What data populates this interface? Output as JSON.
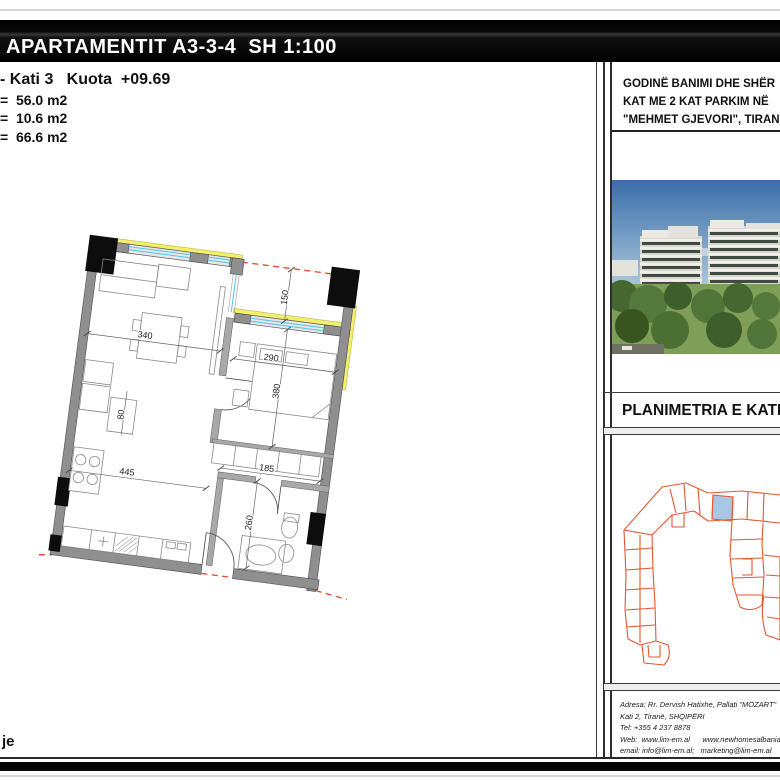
{
  "header": {
    "title": "APARTAMENTIT A3-3-4  SH 1:100"
  },
  "plan_info": {
    "floor_line": "- Kati 3   Kuota  +09.69",
    "area1": "=  56.0 m2",
    "area2": "=  10.6 m2",
    "area3": "=  66.6 m2"
  },
  "floor_plan": {
    "dims": {
      "d340": "340",
      "d150": "150",
      "d290": "290",
      "d380": "380",
      "d80": "80",
      "d445": "445",
      "d185": "185",
      "d260": "260"
    },
    "colors": {
      "wall": "#8f8f8f",
      "column": "#0d0d0d",
      "window_glass": "#4fc3e8",
      "window_sill": "#f2ef6e",
      "boundary_dash": "#e8472e"
    }
  },
  "right_panel": {
    "project_title": {
      "line1": "GODINË BANIMI DHE SHËR",
      "line2": "KAT ME 2 KAT PARKIM NË",
      "line3": "\"MEHMET GJEVORI\", TIRAN"
    },
    "section_title": "PLANIMETRIA E KATI",
    "site_plan": {
      "outline_color": "#e2582c",
      "highlight_color": "#a9c7e4"
    },
    "address": {
      "line1": "Adresa: Rr. Dervish Hatixhe, Pallati \"MOZART\"",
      "line2": "Kati 2, Tiranë, SHQIPËRI",
      "line3": "Tel: +355 4 237 8878",
      "line4": "Web:  www.lim-em.al      www.newhomesalbania.al",
      "line5": "email: info@lim-em.al;   marketing@lim-em.al"
    }
  },
  "footer": {
    "left_text": "je"
  }
}
